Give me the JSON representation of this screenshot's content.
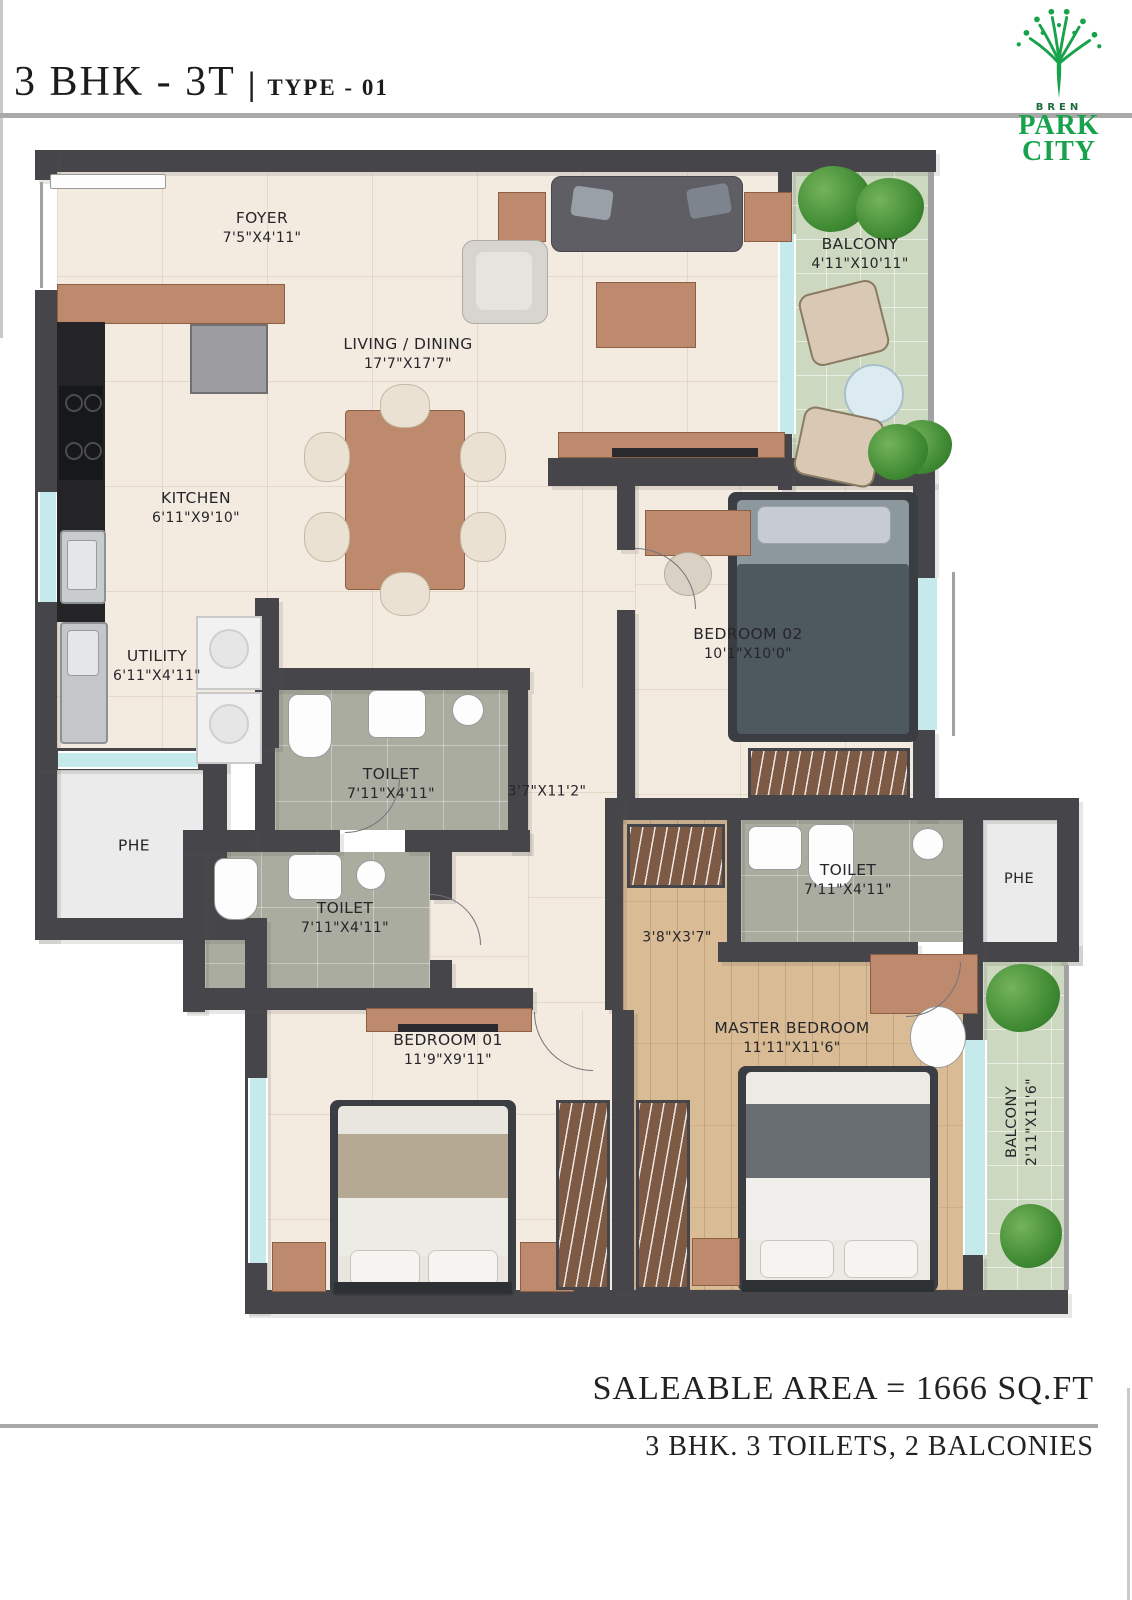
{
  "header": {
    "title_main": "3 BHK - 3T",
    "title_sep": "|",
    "title_sub": "TYPE - 01"
  },
  "logo": {
    "brand": "BREN",
    "line1": "PARK",
    "line2": "CITY",
    "accent_color": "#17a24b"
  },
  "footer": {
    "area_line": "SALEABLE AREA = 1666 SQ.FT",
    "summary_line": "3 BHK. 3 TOILETS, 2 BALCONIES"
  },
  "colors": {
    "wall": "#45454a",
    "floor_cream": "#f3eae0",
    "floor_toilet": "#a9ac9f",
    "floor_balcony": "#ccd8bf",
    "floor_wood": "#d9bc95",
    "window": "#c5eaec",
    "furniture_wood": "#bd8a6d"
  },
  "rooms": {
    "foyer": {
      "name": "FOYER",
      "dims": "7'5\"X4'11\""
    },
    "living": {
      "name": "LIVING / DINING",
      "dims": "17'7\"X17'7\""
    },
    "balcony_top": {
      "name": "BALCONY",
      "dims": "4'11\"X10'11\""
    },
    "kitchen": {
      "name": "KITCHEN",
      "dims": "6'11\"X9'10\""
    },
    "utility": {
      "name": "UTILITY",
      "dims": "6'11\"X4'11\""
    },
    "phe_left": {
      "name": "PHE"
    },
    "toilet_common": {
      "name": "TOILET",
      "dims": "7'11\"X4'11\""
    },
    "corridor": {
      "dims": "3'7\"X11'2\""
    },
    "toilet_bed1": {
      "name": "TOILET",
      "dims": "7'11\"X4'11\""
    },
    "bedroom2": {
      "name": "BEDROOM 02",
      "dims": "10'1\"X10'0\""
    },
    "walkin": {
      "dims": "3'8\"X3'7\""
    },
    "toilet_master": {
      "name": "TOILET",
      "dims": "7'11\"X4'11\""
    },
    "phe_right": {
      "name": "PHE"
    },
    "bedroom1": {
      "name": "BEDROOM 01",
      "dims": "11'9\"X9'11\""
    },
    "master": {
      "name": "MASTER BEDROOM",
      "dims": "11'11\"X11'6\""
    },
    "balcony_right": {
      "name": "BALCONY",
      "dims": "2'11\"X11'6\""
    }
  }
}
